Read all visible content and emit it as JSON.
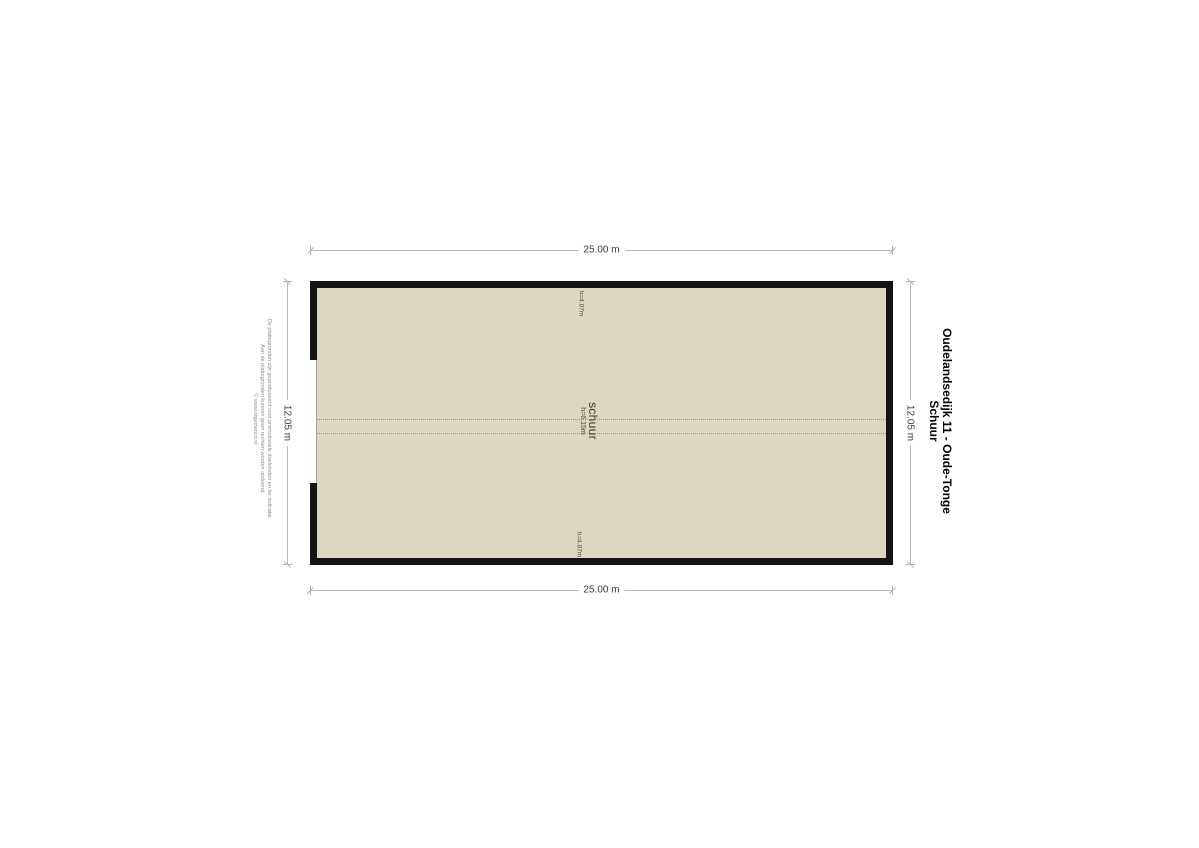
{
  "page": {
    "background": "#ffffff"
  },
  "title_block": {
    "address": "Oudelandsedijk 11 - Oude-Tonge",
    "floor": "Schuur"
  },
  "plan": {
    "fill_color": "#ddd7c1",
    "wall_color": "#141414",
    "room_label": "schuur",
    "room_height_label": "h=6.15m",
    "height_label_top": "h=4.07m",
    "height_label_bottom": "h=4.07m"
  },
  "dimensions": {
    "top": "25.00 m",
    "bottom": "25.00 m",
    "left": "12.05 m",
    "right": "12.05 m"
  },
  "disclaimer": {
    "lines": [
      "De plattegronden zijn geproduceerd voor promotionele doeleinden en ter indicatie.",
      "Aan de plattegronden kunnen geen rechten worden ontleend.",
      "© www.objectenco.nl"
    ]
  }
}
